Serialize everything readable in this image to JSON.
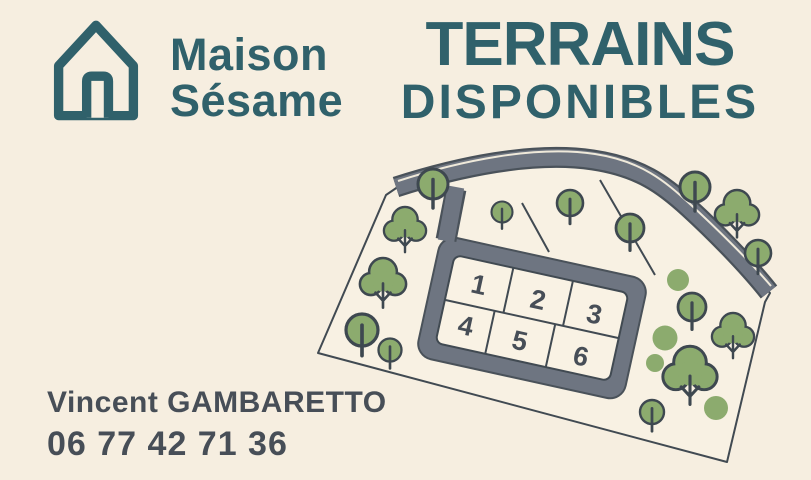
{
  "poster": {
    "brand": {
      "name_line1": "Maison",
      "name_line2": "Sésame"
    },
    "headline": {
      "line1": "TERRAINS",
      "line2": "DISPONIBLES"
    },
    "contact": {
      "name": "Vincent GAMBARETTO",
      "phone": "06 77 42 71 36"
    },
    "site_plan": {
      "plots": [
        "1",
        "2",
        "3",
        "4",
        "5",
        "6"
      ]
    },
    "colors": {
      "background": "#f6eee0",
      "brand_teal": "#30616b",
      "text_dark": "#474e57",
      "road_gray": "#6e7581",
      "road_outline": "#4a525a",
      "tree_green": "#8cab6e",
      "outline_dark": "#3e4850",
      "parcel_fill": "#f8f1e3",
      "road_marking": "#efe9da"
    }
  }
}
